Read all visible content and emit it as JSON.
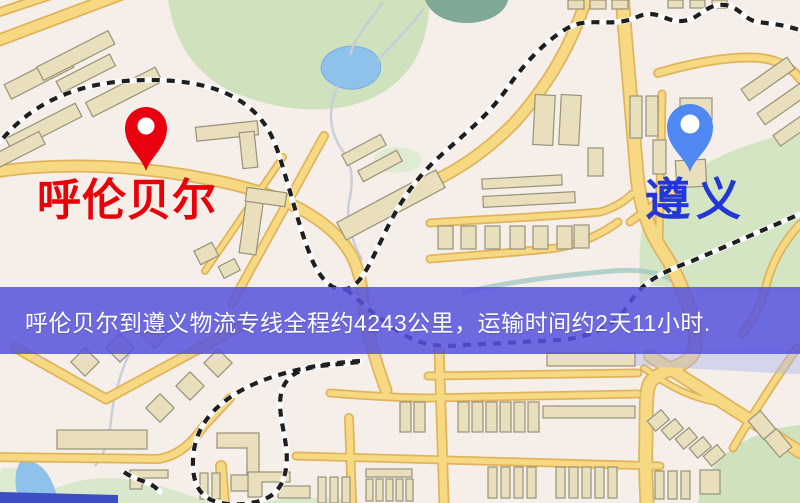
{
  "markers": {
    "origin": {
      "label": "呼伦贝尔",
      "label_color": "#e70008",
      "pin_color": "#e8000f"
    },
    "destination": {
      "label": "遵义",
      "label_color": "#2336d6",
      "pin_color": "#4f88f0"
    }
  },
  "banner": {
    "text": "呼伦贝尔到遵义物流专线全程约4243公里，运输时间约2天11小时.",
    "background_color": "#5553dd",
    "text_color": "#ffffff"
  },
  "route": {
    "origin": "呼伦贝尔",
    "destination": "遵义",
    "distance_text": "约4243公里",
    "duration_text": "约2天11小时"
  },
  "map_colors": {
    "background": "#f6efe9",
    "road": "#f7d983",
    "road_border": "#dfb45c",
    "park_green": "#cfe2bd",
    "water_blue": "#8fc2ea",
    "railway": "#1f1f1f",
    "building": "#e9dfbc"
  }
}
